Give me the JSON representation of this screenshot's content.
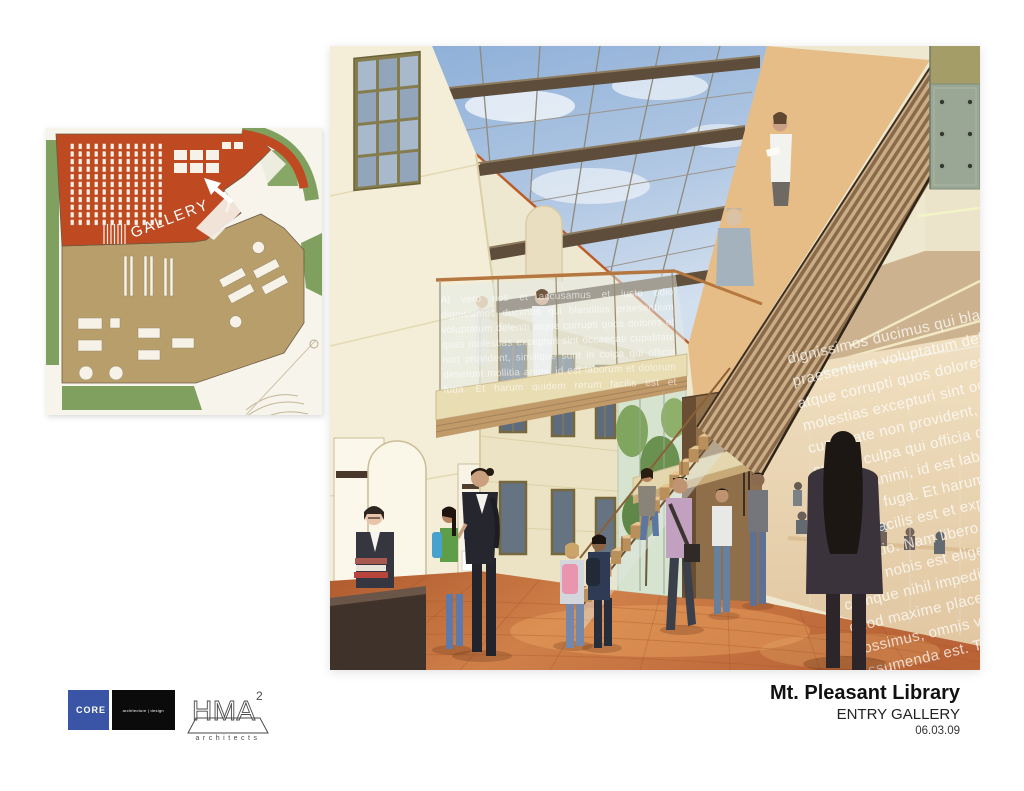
{
  "slide": {
    "background": "#ffffff"
  },
  "floor_plan": {
    "label": "GALLERY",
    "arrow_icon": "arrow-up-left",
    "colors": {
      "gallery_zone": "#bf4a22",
      "library_zone": "#b59c66",
      "landscape": "#7fa05e",
      "paper": "#f7f4ec",
      "outline": "#6b5844"
    }
  },
  "rendering": {
    "scene": "entry-gallery-interior",
    "bridge_glass_text": "At vero eos et accusamus et iusto odio dignissimos ducimus qui blanditiis praesentium voluptatum deleniti atque corrupti quos dolores et quas molestias excepturi sint occaecati cupiditate non provident, similique sunt in culpa qui officia deserunt mollitia animi, id est laborum et dolorum fuga. Et harum quidem rerum facilis est et expedita distinctio. Nam libero tempore, cum soluta nobis est eligendi optio cumque nihil impedit quo minus id quod maxime placeat facere possimus, omnis voluptas assumenda est, omnis dolor repellendus. Temporibus autem quibusdam.",
    "reading_room_glass_text": "dignissimos ducimus qui blanditiis praesentium voluptatum deleniti atque corrupti quos dolores et quas molestias excepturi sint occaecati cupiditate non provident, similique sunt in culpa qui officia deserunt mollitia animi, id est laborum et dolorum fuga. Et harum quidem rerum facilis est et expedita distinctio. Nam libero tempore, cum soluta nobis est eligendi optio cumque nihil impedit quo minus id quod maxime placeat facere possimus, omnis voluptas assumenda est. Temporibus autem quibusdam et aut officiis debitis aut rerum necessitatibus saepe eveniet ut et voluptates repudiandae sint et molestiae non recusandae. Itaque earum rerum hic tenetur a sapiente delectus, ut aut reiciendis voluptatibus maiores alias consequatur aut perferendis doloribus asperiores repellat.",
    "colors": {
      "wall_cream": "#f2ebd3",
      "sky_blue": "#9db8da",
      "beam_brown": "#5d4d3a",
      "wood_slats_dark": "#8a6a4b",
      "wood_slats_light": "#c8ad85",
      "floor_terracotta": "#c26b3a",
      "peach_wall": "#e7bd87"
    }
  },
  "logos": {
    "core": {
      "label": "CORE",
      "tagline": "architecture | design",
      "background": "#3a55a5",
      "tagline_background": "#0b0b0b"
    },
    "hma": {
      "letters": "HMA",
      "superscript": "2",
      "caption": "architects"
    }
  },
  "title_block": {
    "project": "Mt. Pleasant Library",
    "view": "ENTRY GALLERY",
    "date": "06.03.09"
  }
}
